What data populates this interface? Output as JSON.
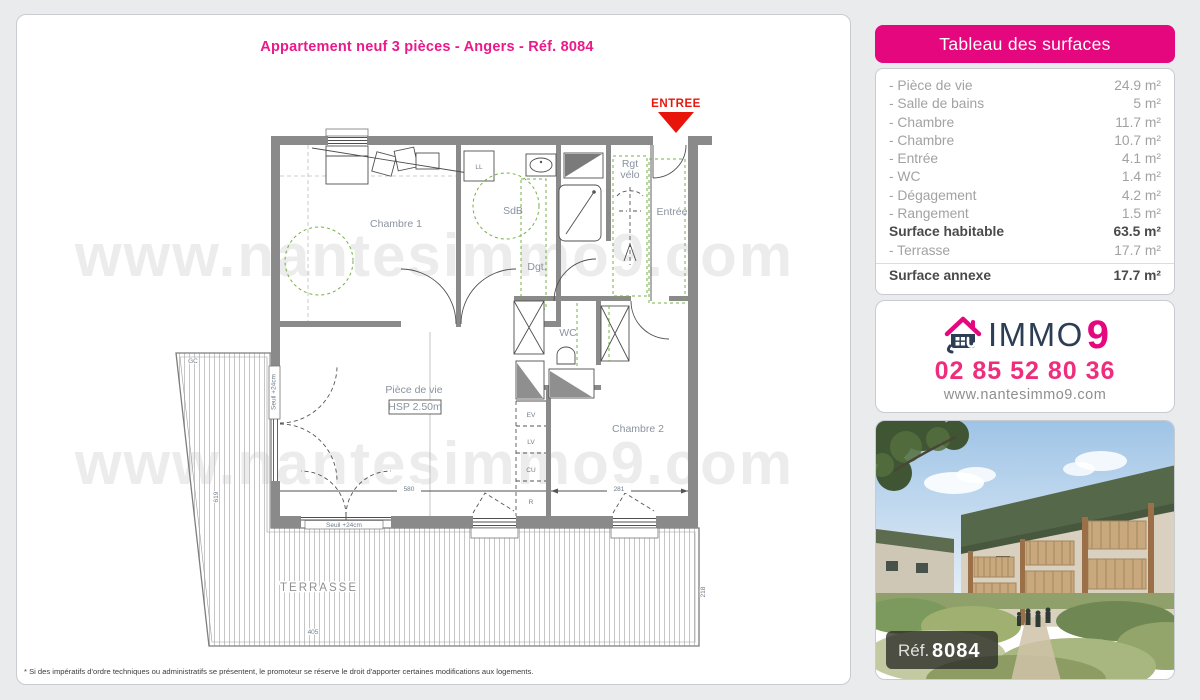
{
  "page": {
    "title": "Appartement neuf 3 pièces - Angers - Réf. 8084",
    "watermark": "www.nantesimmo9.com",
    "disclaimer": "* Si des impératifs d'ordre techniques ou administratifs se présentent, le promoteur se réserve le droit d'apporter certaines modifications aux logements."
  },
  "plan": {
    "entry_marker": "ENTREE",
    "labels": {
      "chambre1": "Chambre 1",
      "sdb": "SdB",
      "ll": "LL",
      "rgt_line1": "Rgt",
      "rgt_line2": "vélo",
      "entree": "Entrée",
      "dgt": "Dgt.",
      "wc": "WC",
      "piece_de_vie": "Pièce de vie",
      "hsp": "HSP 2.50m",
      "chambre2": "Chambre 2",
      "terrasse": "TERRASSE",
      "gc": "GC",
      "seuil": "Seuil +24cm"
    },
    "kitchen": [
      "EV",
      "LV",
      "CU",
      "R"
    ],
    "dims": {
      "chambre2_width": "281",
      "piece_width": "580",
      "terrasse_height": "619",
      "terrasse_width": "405",
      "terrasse_right": "218"
    }
  },
  "surfaces": {
    "header": "Tableau des surfaces",
    "rows": [
      {
        "label": "- Pièce de vie",
        "value": "24.9 m²"
      },
      {
        "label": "- Salle de bains",
        "value": "5 m²"
      },
      {
        "label": "- Chambre",
        "value": "11.7 m²"
      },
      {
        "label": "- Chambre",
        "value": "10.7 m²"
      },
      {
        "label": "- Entrée",
        "value": "4.1 m²"
      },
      {
        "label": "- WC",
        "value": "1.4 m²"
      },
      {
        "label": "- Dégagement",
        "value": "4.2 m²"
      },
      {
        "label": "- Rangement",
        "value": "1.5 m²"
      },
      {
        "label": "Surface habitable",
        "value": "63.5 m²"
      },
      {
        "label": "- Terrasse",
        "value": "17.7 m²"
      },
      {
        "label": "Surface annexe",
        "value": "17.7 m²"
      }
    ]
  },
  "contact": {
    "brand_immo": "IMMO",
    "brand_9": "9",
    "phone": "02 85 52 80 36",
    "website": "www.nantesimmo9.com"
  },
  "photo": {
    "ref_label": "Réf.",
    "ref_value": "8084"
  },
  "colors": {
    "accent_pink": "#e5077e",
    "entry_red": "#e8150d",
    "brand_navy": "#2c3e54"
  }
}
